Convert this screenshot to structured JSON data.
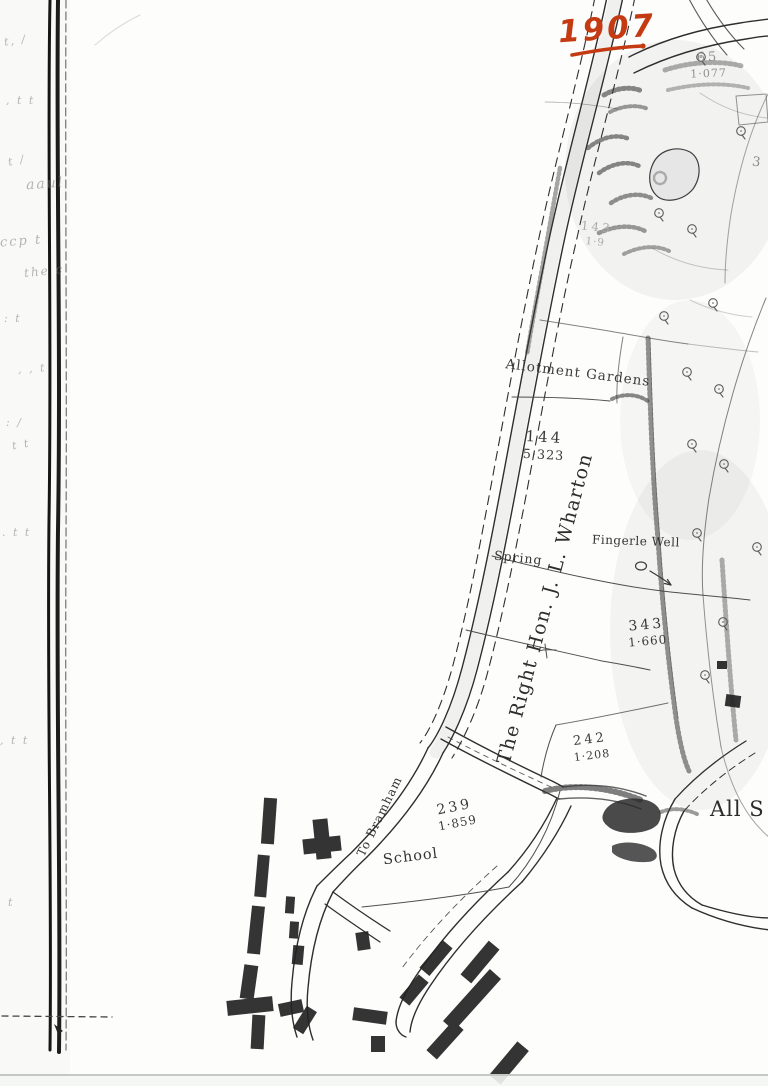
{
  "document": {
    "kind": "scanned 1907 estate map page",
    "year_annotation": "1907"
  },
  "colors": {
    "annotation_ink": "#c43a12",
    "map_ink": "#2e2e2e",
    "faint_ink": "#8a8a8a"
  },
  "labels": {
    "allotment": "Allotment Gardens",
    "spring": "Spring",
    "well": "Fingerle Well",
    "owner": "The Right Hon. J. L. Wharton",
    "school": "School",
    "road_destination": "To Bramham",
    "church": "All S"
  },
  "parcels": [
    {
      "number": "65",
      "area": "1·077"
    },
    {
      "number": "143",
      "area": "1·9"
    },
    {
      "number": "144",
      "area": "5·323"
    },
    {
      "number": "343",
      "area": "1·660"
    },
    {
      "number": "242",
      "area": "1·208"
    },
    {
      "number": "239",
      "area": "1·859"
    }
  ],
  "stray_marks": {
    "number_three": "3"
  },
  "margin_notes": [
    {
      "text": "t, /"
    },
    {
      "text": ", t t"
    },
    {
      "text": "t /"
    },
    {
      "text": "aaul"
    },
    {
      "text": "ccp t"
    },
    {
      "text": "the c"
    },
    {
      "text": ": t"
    },
    {
      "text": ", , t"
    },
    {
      "text": ": /"
    },
    {
      "text": "t t"
    },
    {
      "text": ". t t"
    },
    {
      "text": ", t t"
    },
    {
      "text": "t"
    }
  ]
}
